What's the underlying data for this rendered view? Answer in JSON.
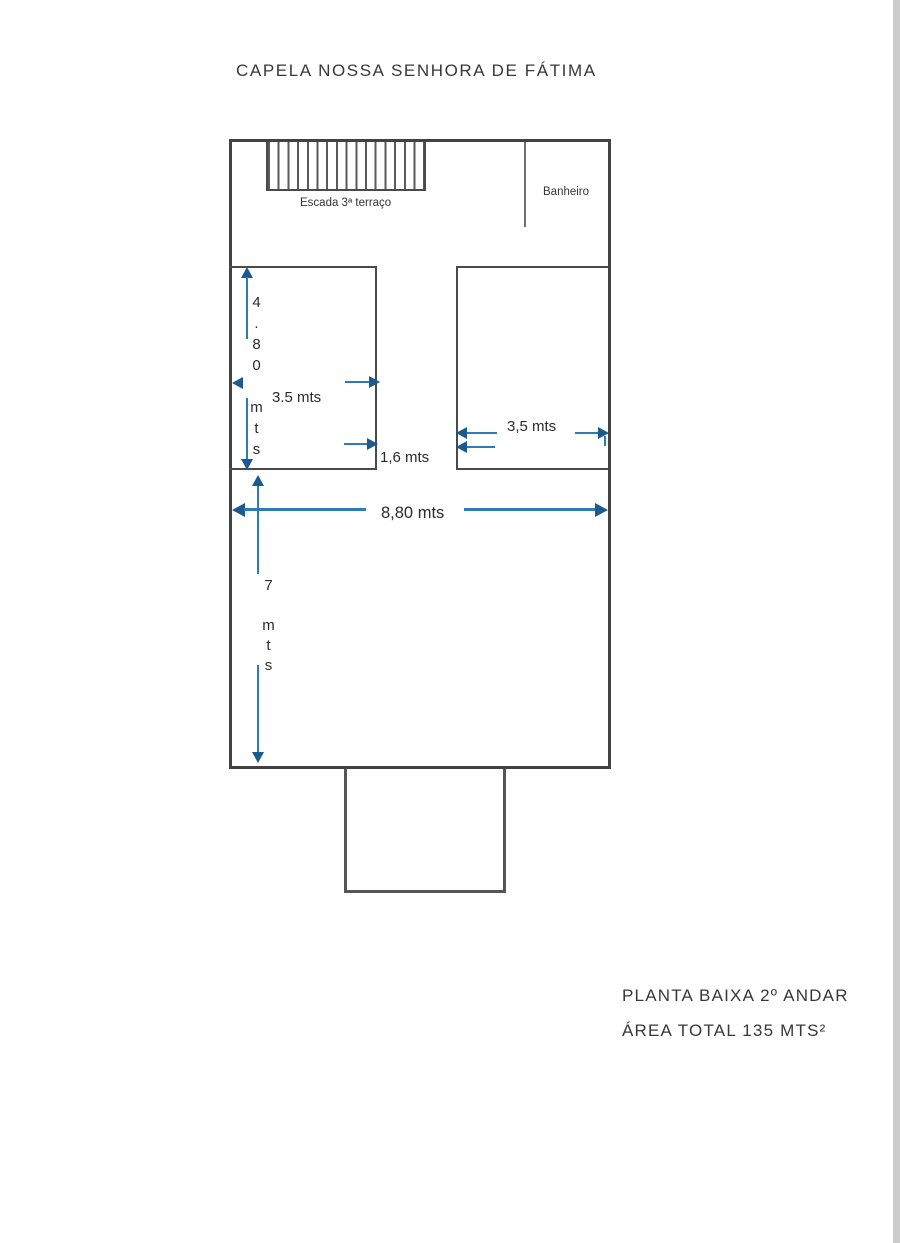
{
  "page": {
    "title": "CAPELA NOSSA SENHORA DE FÁTIMA"
  },
  "plan": {
    "stairs_label": "Escada 3ª terraço",
    "bathroom_label": "Banheiro"
  },
  "dims": {
    "left_room_height": "4.80 mts",
    "left_room_width": "3.5 mts",
    "gap_width": "1,6 mts",
    "right_room_width": "3,5 mts",
    "total_width": "8,80 mts",
    "hall_height": "7 mts"
  },
  "footer": {
    "plan_name": "PLANTA BAIXA 2º ANDAR",
    "area_total": "ÁREA TOTAL 135 MTS²"
  },
  "colors": {
    "wall_gray": "#424242",
    "dimension_blue": "#2e7cb4",
    "arrowhead_blue": "#1a5a8e",
    "page_edge_gray": "#cbcbcb"
  }
}
